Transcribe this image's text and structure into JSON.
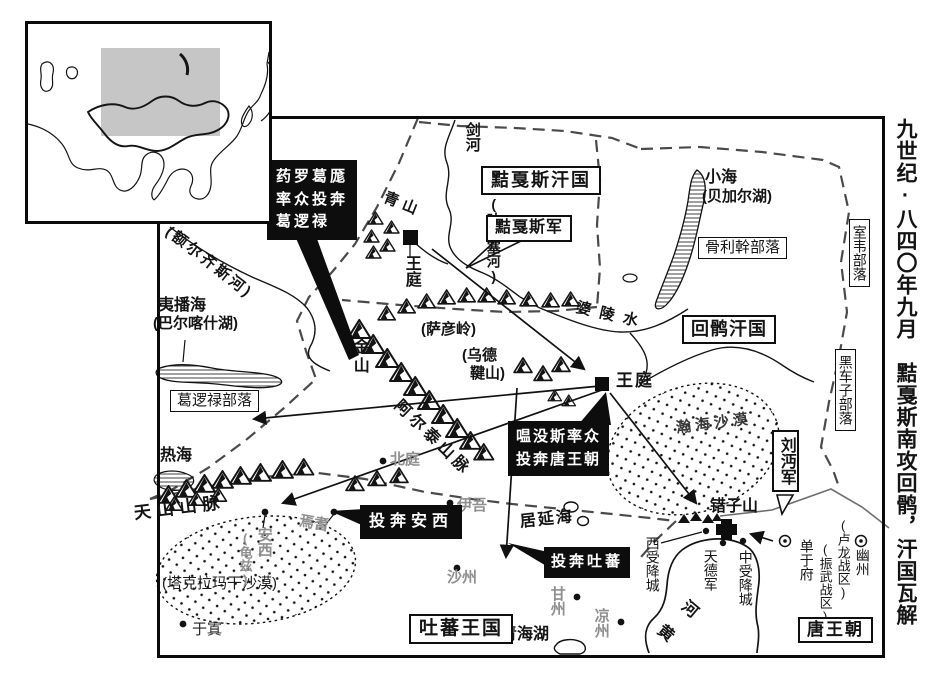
{
  "side_title": "九世纪·八四〇年九月　黠戛斯南攻回鹘，汗国瓦解",
  "colors": {
    "ink": "#141414",
    "gray_text": "#8f8f8f",
    "dash_border": "#4a4a4a",
    "inset_highlight": "#c6c6c6"
  },
  "khanates": {
    "xiajiasi": "黠戛斯汗国",
    "huihu": "回鹘汗国",
    "tubo": "吐蕃王国",
    "tang": "唐王朝"
  },
  "tribes": {
    "guligan": "骨利幹部落",
    "shiwei": "室韦部落",
    "heichezi": "黑车子部落",
    "geluolu": "葛逻禄部落"
  },
  "armies": {
    "xiajiasi_army": "黠戛斯军",
    "liu_mian_army": "刘沔军"
  },
  "events": {
    "yaoluoge_line1": "药罗葛厖",
    "yaoluoge_line2": "率众投奔",
    "yaoluoge_line3": "葛逻禄",
    "wenmosi_line1": "嗢没斯率众",
    "wenmosi_line2": "投奔唐王朝",
    "flee_anxi": "投奔安西",
    "flee_tubo": "投奔吐蕃"
  },
  "courts": {
    "xiajiasi_court": "王庭",
    "huihu_court": "王庭"
  },
  "cities": {
    "beiting": "北庭",
    "yiwu": "伊吾",
    "shazhou": "沙州",
    "yanqi": "焉耆",
    "anxi": "安西",
    "anxi_alt": "(龟兹)",
    "yutian": "于寘",
    "ganzhou": "甘州",
    "liangzhou": "凉州",
    "xishouxiangcheng": "西受降城",
    "tiandejun": "天德军",
    "zhongshouxiangcheng": "中受降城",
    "chanyufu": "单于府",
    "chanyufu_alt": "(振武战区)",
    "youzhou": "幽州",
    "youzhou_alt": "(卢龙战区)"
  },
  "waters": {
    "jianhe": "剑河",
    "jianhe_alt": "(叶尼塞河)",
    "xiaohai": "小海",
    "xiaohai_alt": "(贝加尔湖)",
    "polingshui": "婆陵水",
    "eerqisihe": "(额尔齐斯河)",
    "yibohai": "夷播海",
    "yibohai_alt": "(巴尔喀什湖)",
    "rehai": "热海",
    "juyanhai": "居延海",
    "qinghaihu": "青海湖",
    "huanghe_char1": "黄",
    "huanghe_char2": "河"
  },
  "mountains": {
    "qingshan": "青山",
    "sayanling": "(萨彦岭)",
    "jinshan": "金山",
    "wudejian_l1": "(乌德",
    "wudejian_l2": "鞬山)",
    "aertaishanmai": "阿尔泰山脉",
    "tianshanshanmai": "天山山脉",
    "cuozishan": "错子山"
  },
  "deserts": {
    "hanhai": "瀚海沙漠",
    "takelamagan": "(塔克拉玛干沙漠)"
  }
}
